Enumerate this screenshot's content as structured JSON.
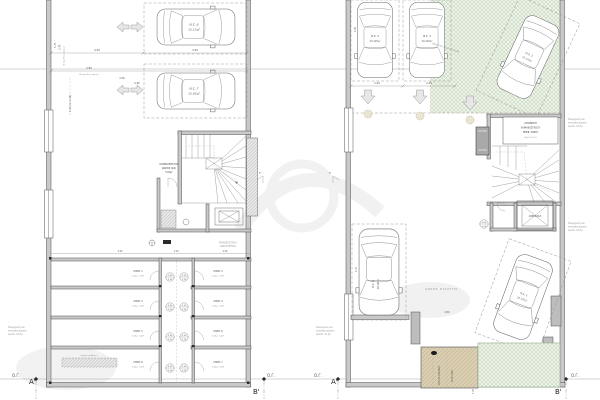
{
  "global": {
    "og_label": "Ο.Γ.",
    "section_a": "Α'",
    "section_b": "Β'",
    "section_c": "Γ'",
    "boundary_note_l1": "Θεωρημένη και",
    "boundary_note_l2": "κατασκευασμένη",
    "boundary_note_l3": "κρασπ. 10.5μ"
  },
  "left_plan": {
    "parking": [
      {
        "id": "Θ.Σ. 6",
        "area": "12.15μ²"
      },
      {
        "id": "Θ.Σ. 7",
        "area": "12.65μ²"
      }
    ],
    "common_space": {
      "l1": "ΚΟΙΝΟΧΡΗΣΤΟΣ",
      "l2": "ΧΩΡΟΣ (ΚΧ)",
      "l3": "3.00μ²"
    },
    "machine_room": {
      "l1": "ΜΗΧΑΝΟΣΤΑΣΙΟ",
      "l2": "ΑΝΕΛΚΥΣΤΗΡΑ"
    },
    "grate_note": "(σχάρα ομβρίων)",
    "storages": [
      {
        "id": "ΑΠΟΘ. 1",
        "area": "3.45μ² (καθ)"
      },
      {
        "id": "ΑΠΟΘ. 2",
        "area": "3.45μ² (καθ)"
      },
      {
        "id": "ΑΠΟΘ. 3",
        "area": "3.45μ² (καθ)"
      },
      {
        "id": "ΑΠΟΘ. 4",
        "area": "3.45μ² (καθ)"
      },
      {
        "id": "ΑΠΟΘ. 5",
        "area": "3.45μ² (καθ)"
      },
      {
        "id": "ΑΠΟΘ. 6",
        "area": "3.45μ² (καθ)"
      },
      {
        "id": "ΑΠΟΘ. 8",
        "area": "3.45μ² (καθ)"
      },
      {
        "id": "ΑΠΟΘ. 7",
        "area": "3.45μ² (καθ)"
      }
    ],
    "door_tag": {
      "top": "0.90",
      "bottom": "2.20"
    },
    "dims": {
      "w1": "4.50",
      "w2": "4.50",
      "d385": "3.85",
      "note": "(Β παρόδιος όψεως)",
      "d256": "2.56",
      "d090": "0.90",
      "d575": "5.75",
      "d370": "3.70",
      "vnote": "(Δ παρόδιος όψεως)",
      "d140": "1.40 (min 1.10)",
      "c220a": "2.20",
      "c110": "1.10",
      "c220b": "2.20"
    }
  },
  "right_plan": {
    "parking": [
      {
        "id": "Θ.Σ. 4",
        "area": "10.125μ²"
      },
      {
        "id": "Θ.Σ. 3",
        "area": "10.125μ²"
      },
      {
        "id": "Θ.Σ. 2",
        "area": "10.125μ²"
      },
      {
        "id": "Θ.Σ. 5",
        "area": "10.125μ²"
      },
      {
        "id": "Θ.Σ. 1",
        "area": "10.125μ²"
      }
    ],
    "open_parking_note": "ΑΝΟΙΚΤΕΣ ΘΕΣΕΙΣ ΣΤΑΘΜ.",
    "stair_store": {
      "l1": "ΑΠΟΘΗΚΗ",
      "l2": "ΚΛΙΜΑΚΟΣΤΑΣΙΟΥ",
      "l3": "ΠΕΡΙΒ. ΧΩΡΟΥ",
      "l4": "(Εμβ.=3.1μ²)"
    },
    "elevator_label": "ΑΝΕΛΚ/ΡΑΣ",
    "pilotis_label": "ΧΩΡΟΣ ΠΙΛΟΤΗΣ",
    "ramp": {
      "l1": "ΡΑΜΠΑ ΚΑΘΟΔΟΥ",
      "l2": "ΚΛΙΣΗ 18%"
    },
    "door_tag": {
      "top": "0.90",
      "bottom": "2.20"
    },
    "dims": {
      "d225a": "2.25",
      "d225b": "2.25",
      "d450": "4.50",
      "d150": "1.50",
      "d435": "4.35",
      "d145": "1.45",
      "d150b": "1.50"
    }
  },
  "colors": {
    "hatch_green": "#a9c49e",
    "hatch_green_bg": "#eef4ea",
    "ramp_tan": "#d9cdb2",
    "wall_gray": "#c9c9c9",
    "line": "#4d4d4d"
  }
}
